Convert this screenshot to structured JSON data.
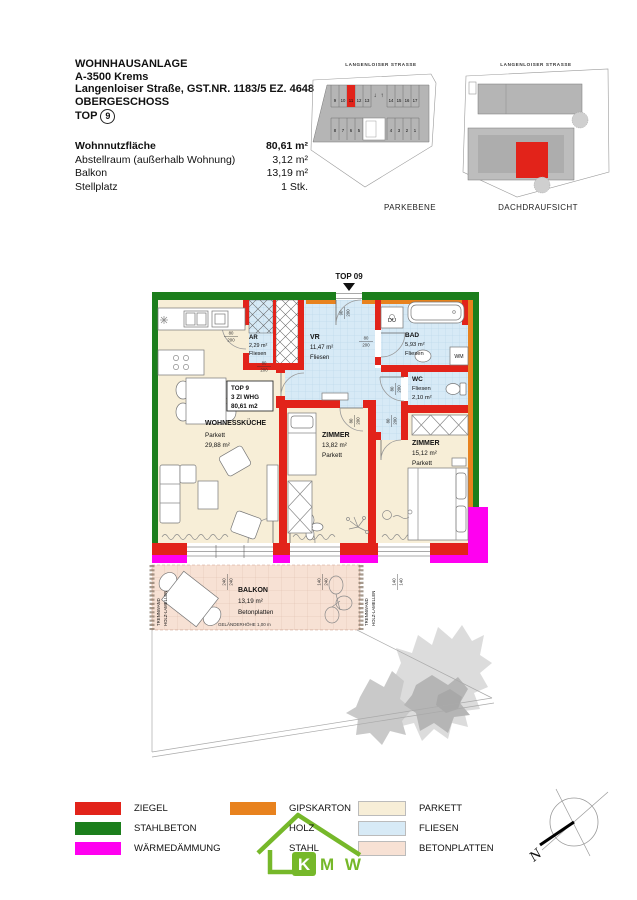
{
  "colors": {
    "ziegel": "#e2231a",
    "stahlbeton": "#1c7e1c",
    "waermedaemmung": "#ff00f0",
    "gipskarton": "#e8821e",
    "parkett": "#f7eed7",
    "fliesen": "#d7eaf6",
    "betonplatten": "#f7e1d4",
    "logo_green": "#76b82a"
  },
  "header": {
    "line1": "WOHNHAUSANLAGE",
    "line2": "A-3500 Krems",
    "line3": "Langenloiser Straße, GST.NR. 1183/5 EZ. 4648",
    "line4": "OBERGESCHOSS",
    "top_prefix": "TOP",
    "top_number": "9"
  },
  "area_table": {
    "rows": [
      {
        "label": "Wohnnutzfläche",
        "value": "80,61 m²"
      },
      {
        "label": "Abstellraum (außerhalb Wohnung)",
        "value": "3,12 m²"
      },
      {
        "label": "Balkon",
        "value": "13,19 m²"
      },
      {
        "label": "Stellplatz",
        "value": "1 Stk."
      }
    ]
  },
  "site_plans": {
    "street_label": "LANGENLOISER STRASSE",
    "parkebene": {
      "caption": "PARKEBENE",
      "spaces_top_left": [
        "9",
        "10",
        "11",
        "12",
        "13"
      ],
      "spaces_top_right": [
        "14",
        "15",
        "16",
        "17"
      ],
      "spaces_bottom_left": [
        "8",
        "7",
        "6",
        "5"
      ],
      "spaces_bottom_right": [
        "4",
        "3",
        "2",
        "1"
      ],
      "highlighted_space": "11",
      "arrow_down": "↓",
      "arrow_up": "↑"
    },
    "dach": {
      "caption": "DACHDRAUFSICHT"
    }
  },
  "plan": {
    "entrance_label": "TOP 09",
    "rooms": {
      "ar": {
        "lines": [
          "AR",
          "2,29 m²",
          "Fliesen"
        ]
      },
      "vr": {
        "lines": [
          "VR",
          "11,47 m²",
          "Fliesen"
        ]
      },
      "bad": {
        "lines": [
          "BAD",
          "5,93 m²",
          "Fliesen"
        ]
      },
      "wc": {
        "lines": [
          "WC",
          "Fliesen",
          "2,10 m²"
        ]
      },
      "wohnkueche": {
        "lines": [
          "WOHNESSKÜCHE",
          "Parkett",
          "29,88 m²"
        ]
      },
      "zimmer1": {
        "lines": [
          "ZIMMER",
          "13,82 m²",
          "Parkett"
        ]
      },
      "zimmer2": {
        "lines": [
          "ZIMMER",
          "15,12 m²",
          "Parkett"
        ]
      },
      "balkon": {
        "lines": [
          "BALKON",
          "13,19 m²",
          "Betonplatten"
        ],
        "railing": "GELÄNDERHÖHE 1,00 m"
      }
    },
    "unit_box": {
      "lines": [
        "TOP 9",
        "3 ZI WHG",
        "80,61 m2"
      ]
    },
    "fixtures": {
      "du": "DU",
      "wm": "WM"
    },
    "partition": {
      "line1": "TRENNWAND",
      "line2": "HOLZ-LAMELLEN"
    },
    "dims": {
      "d80": "80",
      "d90": "90",
      "d200": "200",
      "d240": "240",
      "d140": "140"
    }
  },
  "legend": {
    "items": [
      "ZIEGEL",
      "STAHLBETON",
      "WÄRMEDÄMMUNG",
      "GIPSKARTON",
      "HOLZ",
      "STAHL",
      "PARKETT",
      "FLIESEN",
      "BETONPLATTEN"
    ]
  },
  "logo": {
    "k": "K",
    "mw": "M W"
  },
  "compass": {
    "north": "N"
  }
}
